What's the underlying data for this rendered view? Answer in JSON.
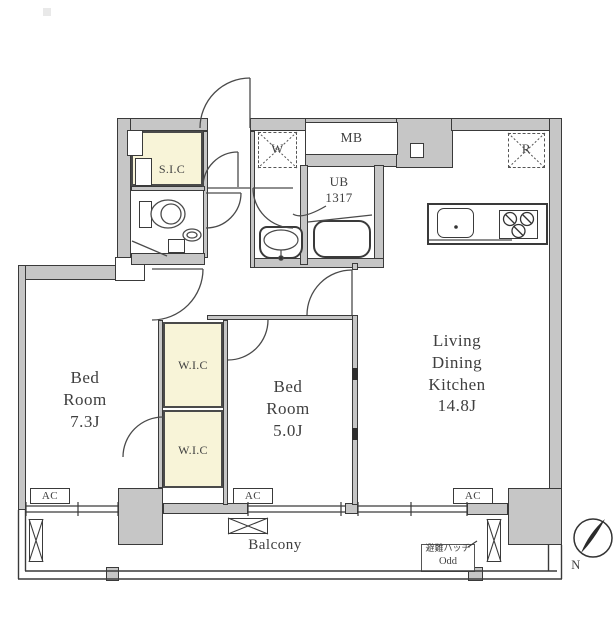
{
  "colors": {
    "wall": "#c6c6c6",
    "wall_border": "#3a3a3a",
    "closet": "#f8f4d8",
    "line": "#4a4a4a",
    "text": "#3f3f3f"
  },
  "rooms": {
    "bedroom1": {
      "lines": [
        "Bed",
        "Room",
        "7.3J"
      ]
    },
    "bedroom2": {
      "lines": [
        "Bed",
        "Room",
        "5.0J"
      ]
    },
    "ldk": {
      "lines": [
        "Living",
        "Dining",
        "Kitchen",
        "14.8J"
      ]
    },
    "wic_upper": "W.I.C",
    "wic_lower": "W.I.C",
    "sic": "S.I.C",
    "mb": "MB",
    "ub": {
      "lines": [
        "UB",
        "1317"
      ]
    },
    "balcony": "Balcony"
  },
  "fixtures": {
    "washer": "W",
    "refrigerator": "R",
    "ac": [
      "AC",
      "AC",
      "AC"
    ],
    "evac_hatch": {
      "lines": [
        "避難ハッチ",
        "Odd"
      ]
    },
    "compass_north": "N"
  }
}
